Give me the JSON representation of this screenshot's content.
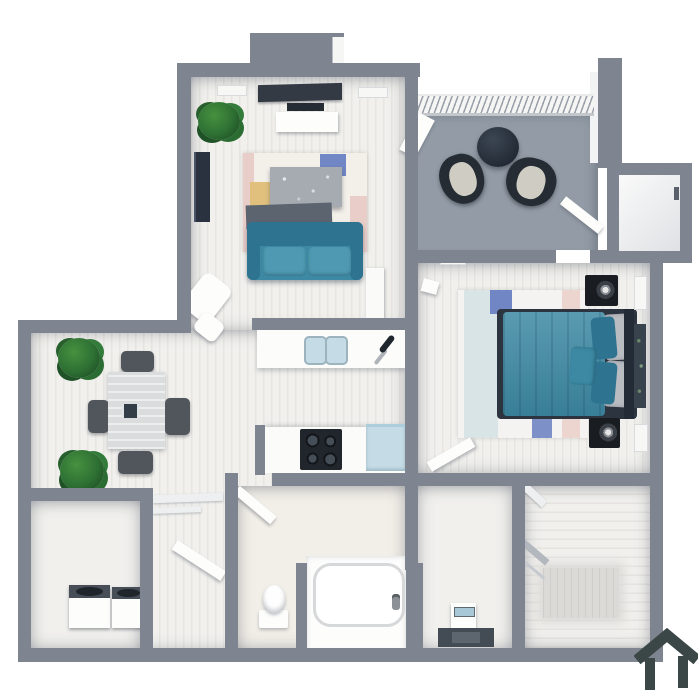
{
  "scene": {
    "type": "3d-floor-plan-render",
    "description": "top-down 3D apartment floor plan, one bedroom with balcony",
    "background": "#ffffff"
  },
  "watermark": {
    "icon": "house-logo-icon",
    "color": "#3b4647"
  },
  "colors": {
    "background": "#ffffff",
    "wall": "#7e8490",
    "floor": "#f1f0ed",
    "balconyFloor": "#939ca6",
    "closetFloor": "#dbdad7",
    "teal": "#3d89a3",
    "tealDark": "#2e7390",
    "tealLight": "#4f9ab2",
    "navy": "#2c3440",
    "darkGray": "#39414b",
    "slate": "#5c6470",
    "marble": "#a6abb2",
    "chairGray": "#51565c",
    "plantGreen": "#2d6f33",
    "plantDark": "#1d4c23",
    "lightBlue": "#c5dce6",
    "pillowGray": "#b9bcc1",
    "cushion": "#cfccc4",
    "rugPink": "#e9cdc8",
    "rugYellow": "#e0c07c",
    "rugBlue": "#7186c5",
    "logo": "#3b4647"
  },
  "rooms": [
    {
      "name": "living-room",
      "items": [
        "tv",
        "soundbar",
        "media-console",
        "air-vent",
        "air-vent",
        "potted-plant",
        "wall-art",
        "area-rug",
        "coffee-table",
        "bench",
        "sofa",
        "lounge-chair",
        "ottoman"
      ]
    },
    {
      "name": "balcony",
      "items": [
        "railing",
        "round-table",
        "patio-chair",
        "patio-chair",
        "open-door",
        "open-door"
      ]
    },
    {
      "name": "entry",
      "items": [
        "door"
      ]
    },
    {
      "name": "bedroom",
      "items": [
        "bed",
        "duvet",
        "headboard",
        "pillows",
        "throw-pillow",
        "area-rug",
        "speaker",
        "speaker",
        "air-vent",
        "open-door"
      ]
    },
    {
      "name": "dining-area",
      "items": [
        "dining-table",
        "centerpiece",
        "chair",
        "chair",
        "chair",
        "chair",
        "potted-plant",
        "potted-plant"
      ]
    },
    {
      "name": "kitchen",
      "items": [
        "island-counter",
        "double-sink",
        "faucet",
        "counter",
        "stove",
        "refrigerator"
      ]
    },
    {
      "name": "laundry-room",
      "items": [
        "washer",
        "dryer"
      ]
    },
    {
      "name": "hallway",
      "items": [
        "linen-shelves",
        "open-door"
      ]
    },
    {
      "name": "bathroom",
      "items": [
        "toilet",
        "bathtub",
        "tub-faucet",
        "open-door"
      ]
    },
    {
      "name": "vanity-area",
      "items": [
        "vanity-sink",
        "bath-mat"
      ]
    },
    {
      "name": "walk-in-closet",
      "items": [
        "shelf",
        "shelf",
        "floor-mat"
      ]
    },
    {
      "name": "storage-closet",
      "items": [
        "door"
      ]
    }
  ]
}
